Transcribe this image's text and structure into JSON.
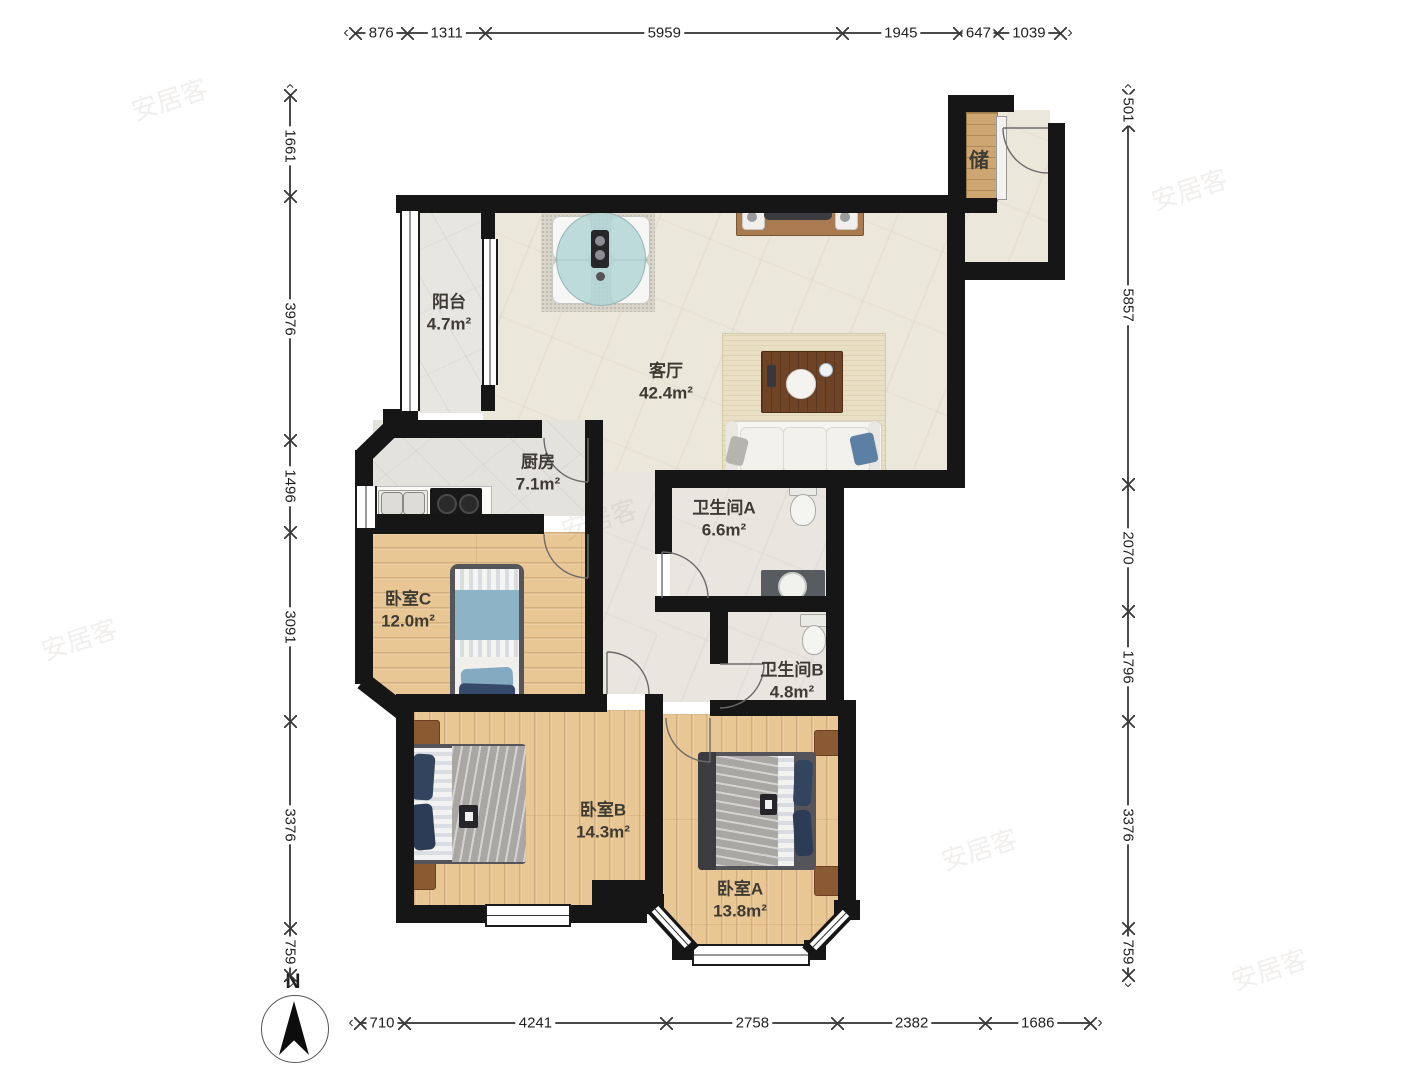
{
  "plan": {
    "rooms": {
      "balcony": {
        "name": "阳台",
        "area": "4.7m²"
      },
      "living": {
        "name": "客厅",
        "area": "42.4m²"
      },
      "kitchen": {
        "name": "厨房",
        "area": "7.1m²"
      },
      "bath_a": {
        "name": "卫生间A",
        "area": "6.6m²"
      },
      "bath_b": {
        "name": "卫生间B",
        "area": "4.8m²"
      },
      "bed_c": {
        "name": "卧室C",
        "area": "12.0m²"
      },
      "bed_b": {
        "name": "卧室B",
        "area": "14.3m²"
      },
      "bed_a": {
        "name": "卧室A",
        "area": "13.8m²"
      },
      "storage": {
        "name": "储"
      }
    },
    "compass": {
      "label": "N"
    },
    "watermark": "安居客"
  },
  "dimensions_mm": {
    "top": [
      876,
      1311,
      5959,
      1945,
      647,
      1039
    ],
    "bottom": [
      710,
      4241,
      2758,
      2382,
      1686
    ],
    "left": [
      1661,
      3976,
      1496,
      3091,
      3376,
      759
    ],
    "right": [
      501,
      5857,
      2070,
      1796,
      3376,
      759
    ]
  },
  "colors": {
    "wall": "#161616",
    "wood_floor": "#e9c795",
    "living_floor": "#ece7db",
    "blanket_gray": "#a8a7a3",
    "pillow_navy": "#33445f",
    "blanket_blue": "#8cb4c6",
    "table_glass": "#b0d4d6",
    "wood_furniture": "#8a5a33"
  }
}
